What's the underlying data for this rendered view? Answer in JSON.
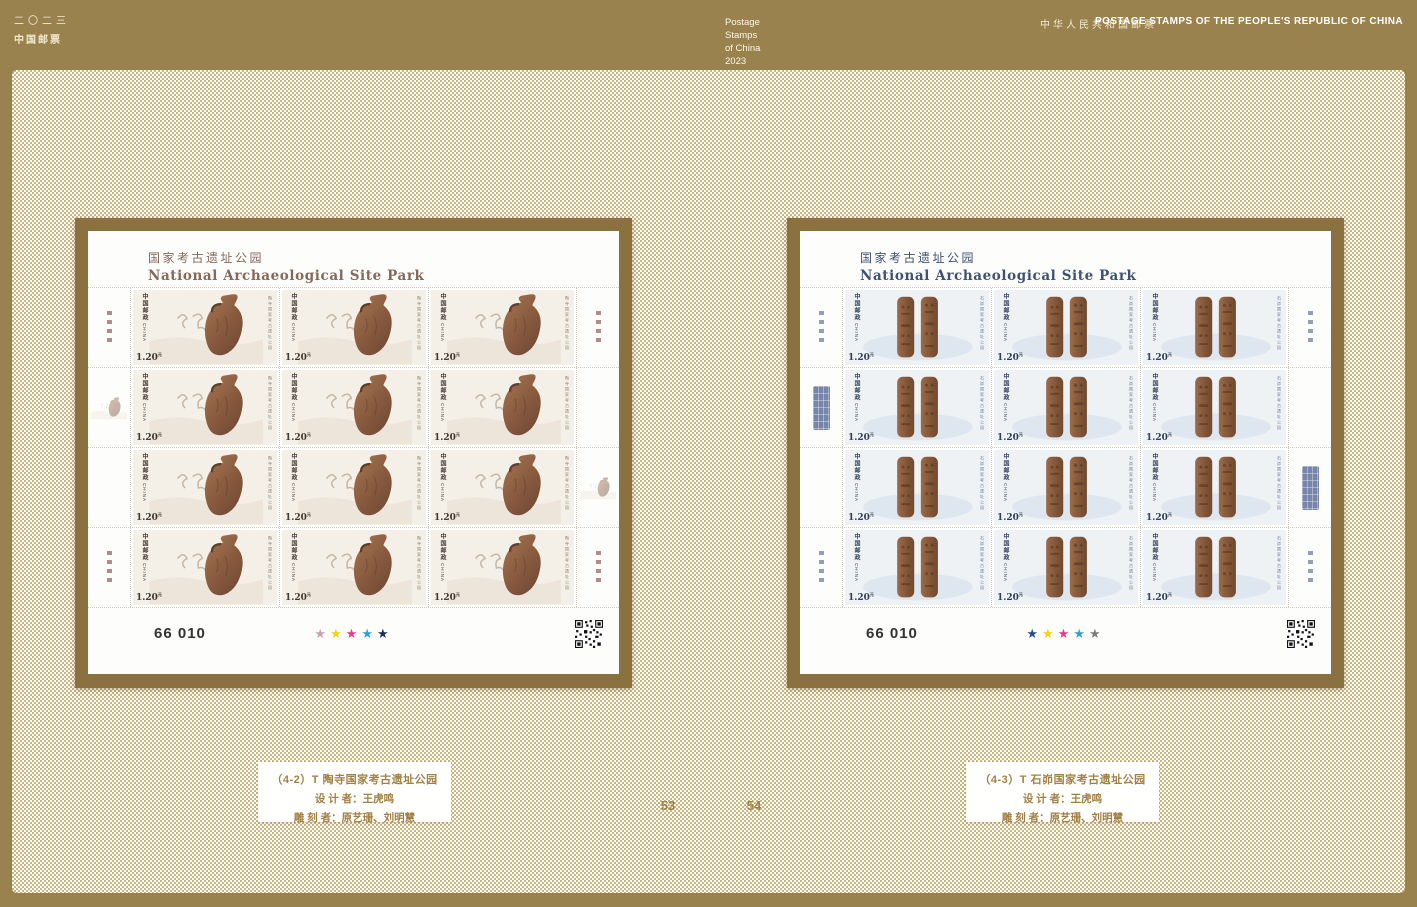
{
  "header": {
    "year_cn": "二〇二三",
    "brand_cn": "中国邮票",
    "center_lines": [
      "Postage",
      "Stamps",
      "of China",
      "2023"
    ],
    "right_cn": "中华人民共和国邮票",
    "right_en": "POSTAGE STAMPS OF THE PEOPLE'S REPUBLIC OF CHINA"
  },
  "page_numbers": {
    "left": "53",
    "right": "54"
  },
  "colors": {
    "page_gold": "#99824d",
    "checker_tan": "#ccb67e",
    "frame_gold": "#8c7140",
    "caption_text": "#a18044"
  },
  "sheets": [
    {
      "title_cn": "国家考古遗址公园",
      "title_en": "National Archaeological Site Park",
      "title_color": "#84695c",
      "sheet_number": "66 010",
      "rows": 4,
      "cols": 3,
      "stamp": {
        "post_cn": "中国邮政",
        "post_en": "CHINA",
        "denomination": "1.20",
        "currency": "元",
        "side_title": "陶寺国家考古遗址公园",
        "art": "pottery",
        "bg": "#f4efe7",
        "ink": "#433931",
        "side_color": "#8d8278"
      },
      "star_colors": [
        "#c9a3ad",
        "#f5d500",
        "#e73a8e",
        "#2e9fd8",
        "#23304f"
      ],
      "ornament_color": "#9c7070",
      "caption": {
        "line1": "（4-2）T 陶寺国家考古遗址公园",
        "line2": "设 计 者：王虎鸣",
        "line3": "雕 刻 者：原艺珊、刘明慧"
      }
    },
    {
      "title_cn": "国家考古遗址公园",
      "title_en": "National Archaeological Site Park",
      "title_color": "#3f5273",
      "sheet_number": "66 010",
      "rows": 4,
      "cols": 3,
      "stamp": {
        "post_cn": "中国邮政",
        "post_en": "CHINA",
        "denomination": "1.20",
        "currency": "元",
        "side_title": "石峁国家考古遗址公园",
        "art": "pillars",
        "bg": "#eef2f5",
        "ink": "#31405e",
        "side_color": "#6e7a94"
      },
      "star_colors": [
        "#2c4d8e",
        "#f5d500",
        "#e73a8e",
        "#2e9fd8",
        "#7d7d7d"
      ],
      "ornament_color": "#7a87a8",
      "caption": {
        "line1": "（4-3）T 石峁国家考古遗址公园",
        "line2": "设 计 者：王虎鸣",
        "line3": "雕 刻 者：原艺珊、刘明慧"
      }
    }
  ]
}
